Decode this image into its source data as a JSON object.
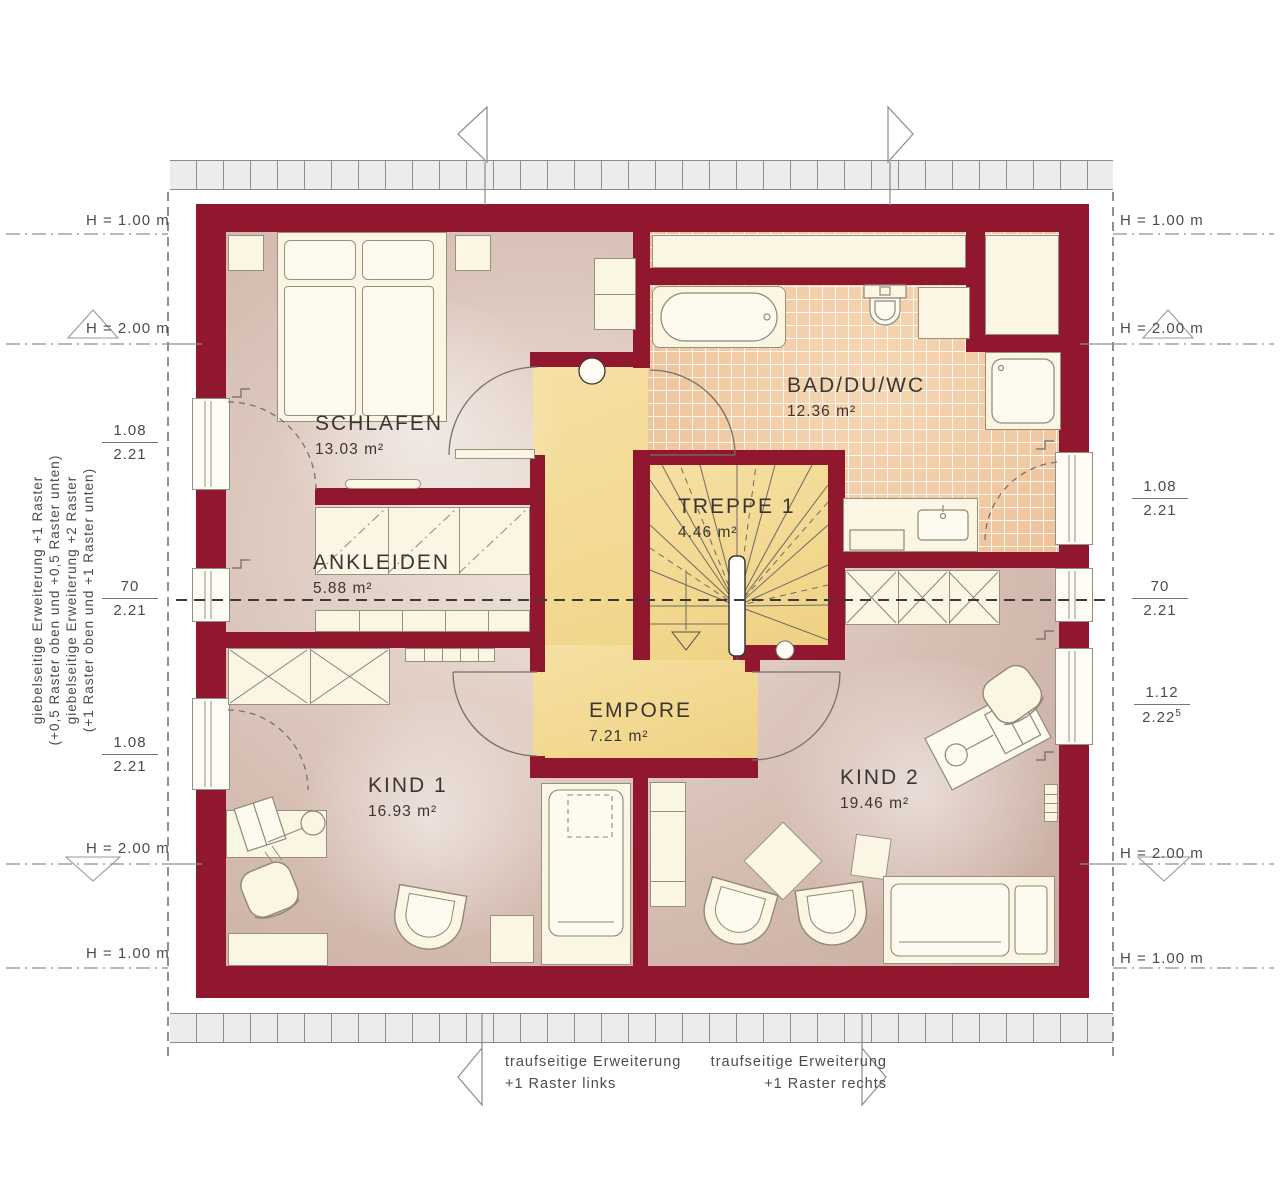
{
  "colors": {
    "wall": "#90172d",
    "floor": "#d7bfb4",
    "floor_light": "#eee2da",
    "tile": "#f0c79f",
    "stair_floor": "#f2d78e",
    "furniture": "#fbf6e4",
    "line": "#6f6a64",
    "text": "#3a3634",
    "muted": "#4c4c4c"
  },
  "rooms": [
    {
      "id": "schlafen",
      "name": "SCHLAFEN",
      "area": "13.03 m²"
    },
    {
      "id": "ankleiden",
      "name": "ANKLEIDEN",
      "area": "5.88 m²"
    },
    {
      "id": "bad",
      "name": "BAD/DU/WC",
      "area": "12.36 m²"
    },
    {
      "id": "treppe",
      "name": "TREPPE 1",
      "area": "4.46 m²"
    },
    {
      "id": "empore",
      "name": "EMPORE",
      "area": "7.21 m²"
    },
    {
      "id": "kind1",
      "name": "KIND 1",
      "area": "16.93 m²"
    },
    {
      "id": "kind2",
      "name": "KIND 2",
      "area": "19.46 m²"
    }
  ],
  "left_annotations": {
    "h_top1": "H = 1.00 m",
    "h_top2": "H = 2.00 m",
    "win1": {
      "top": "1.08",
      "bottom": "2.21"
    },
    "win2": {
      "top": "70",
      "bottom": "2.21"
    },
    "win3": {
      "top": "1.08",
      "bottom": "2.21"
    },
    "h_bottom2": "H = 2.00 m",
    "h_bottom1": "H = 1.00 m",
    "note1_line1": "giebelseitige Erweiterung +1 Raster",
    "note1_line2": "(+0,5 Raster oben und +0,5 Raster unten)",
    "note2_line1": "giebelseitige Erweiterung +2 Raster",
    "note2_line2": "(+1 Raster oben und +1 Raster unten)"
  },
  "right_annotations": {
    "h_top1": "H = 1.00 m",
    "h_top2": "H = 2.00 m",
    "win1": {
      "top": "1.08",
      "bottom": "2.21"
    },
    "win2": {
      "top": "70",
      "bottom": "2.21"
    },
    "win3": {
      "top": "1.12",
      "bottom": "2.22",
      "bottom_sup": "5"
    },
    "h_bottom2": "H = 2.00 m",
    "h_bottom1": "H = 1.00 m"
  },
  "bottom_annotations": {
    "left_line1": "traufseitige Erweiterung",
    "left_line2": "+1 Raster links",
    "right_line1": "traufseitige Erweiterung",
    "right_line2": "+1 Raster rechts"
  }
}
